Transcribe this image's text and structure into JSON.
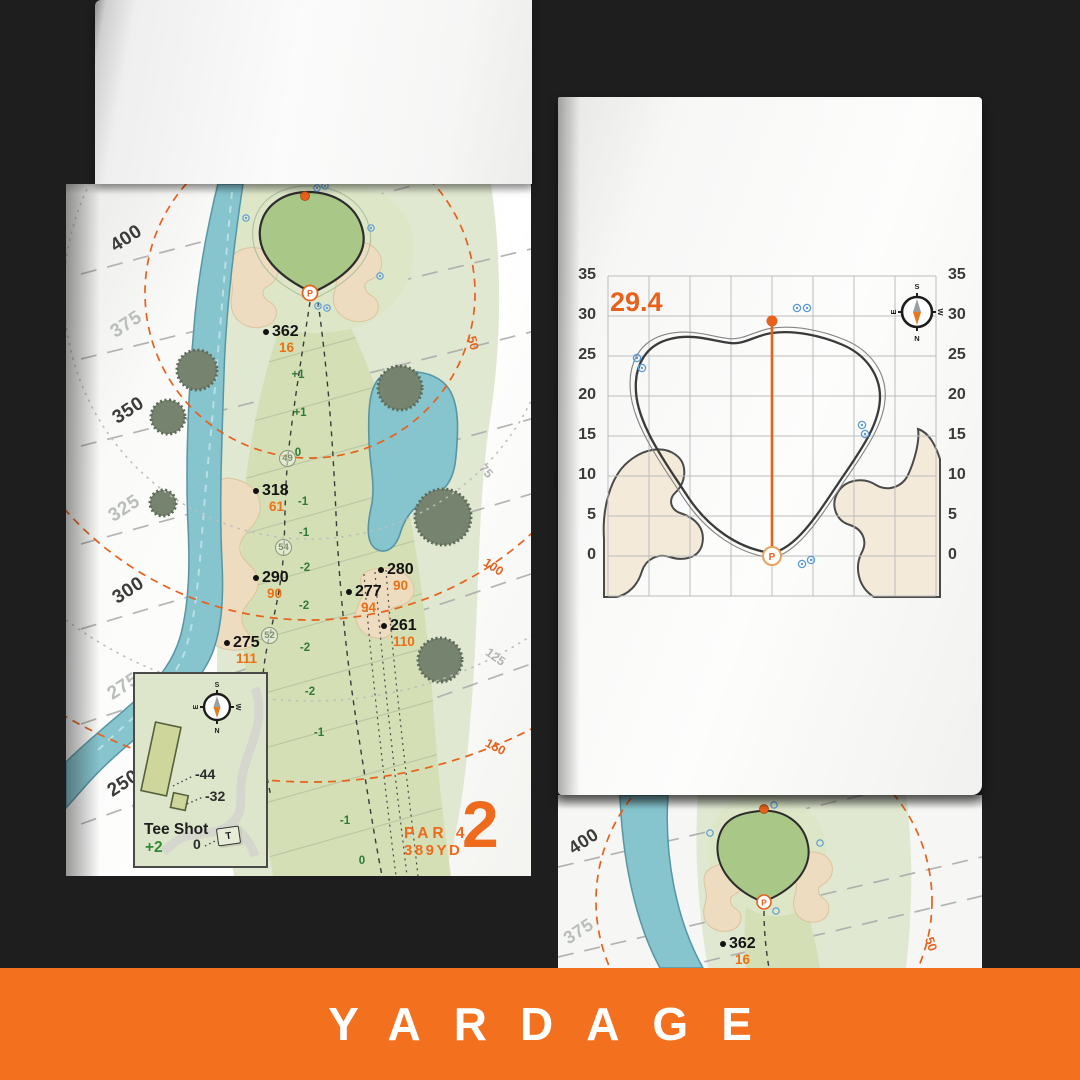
{
  "banner": {
    "label": "YARDAGE"
  },
  "colors": {
    "accent_orange": "#e8611c",
    "banner_orange": "#f3701e",
    "water_blue": "#86c4ce",
    "green_fill": "#a9c887",
    "fairway_fill": "#d4dfb5",
    "sand_fill": "#eedcc0",
    "sprinkler_blue": "#5b9bd5"
  },
  "left_page": {
    "hole_number": "2",
    "par_label": "PAR 4",
    "yardage_label": "389YD",
    "distance_labels": [
      {
        "text": "400",
        "tone": "dark"
      },
      {
        "text": "375",
        "tone": "light"
      },
      {
        "text": "350",
        "tone": "dark"
      },
      {
        "text": "325",
        "tone": "light"
      },
      {
        "text": "300",
        "tone": "dark"
      },
      {
        "text": "275",
        "tone": "light"
      },
      {
        "text": "250",
        "tone": "dark"
      }
    ],
    "arc_labels": [
      {
        "text": "50",
        "tone": "orange"
      },
      {
        "text": "75",
        "tone": "gray"
      },
      {
        "text": "100",
        "tone": "orange"
      },
      {
        "text": "125",
        "tone": "gray"
      },
      {
        "text": "150",
        "tone": "orange"
      }
    ],
    "yardage_markers": [
      {
        "distance": "362",
        "carry": "16"
      },
      {
        "distance": "318",
        "carry": "61"
      },
      {
        "distance": "290",
        "carry": "90"
      },
      {
        "distance": "280",
        "carry": "90"
      },
      {
        "distance": "277",
        "carry": "94"
      },
      {
        "distance": "261",
        "carry": "110"
      },
      {
        "distance": "275",
        "carry": "111"
      }
    ],
    "elevation_values": [
      "+1",
      "+1",
      "0",
      "-1",
      "-1",
      "-2",
      "-2",
      "-2",
      "-2",
      "-1",
      "-1",
      "0"
    ],
    "circled_values": [
      "49",
      "54",
      "52"
    ],
    "tee_inset": {
      "title": "Tee Shot",
      "score": "+2",
      "tee_labels": [
        "-44",
        "-32",
        "0"
      ],
      "tee_icon": "T",
      "compass": {
        "n": "N",
        "s": "S",
        "e": "E",
        "w": "W"
      }
    }
  },
  "right_page": {
    "pin_depth": "29.4",
    "axis_ticks": [
      "35",
      "30",
      "25",
      "20",
      "15",
      "10",
      "5",
      "0"
    ],
    "compass": {
      "n": "N",
      "s": "S",
      "e": "E",
      "w": "W"
    }
  },
  "under_page": {
    "distance_labels": [
      {
        "text": "400",
        "tone": "dark"
      },
      {
        "text": "375",
        "tone": "light"
      }
    ],
    "arc_label": "50",
    "yardage_marker": {
      "distance": "362",
      "carry": "16"
    }
  }
}
